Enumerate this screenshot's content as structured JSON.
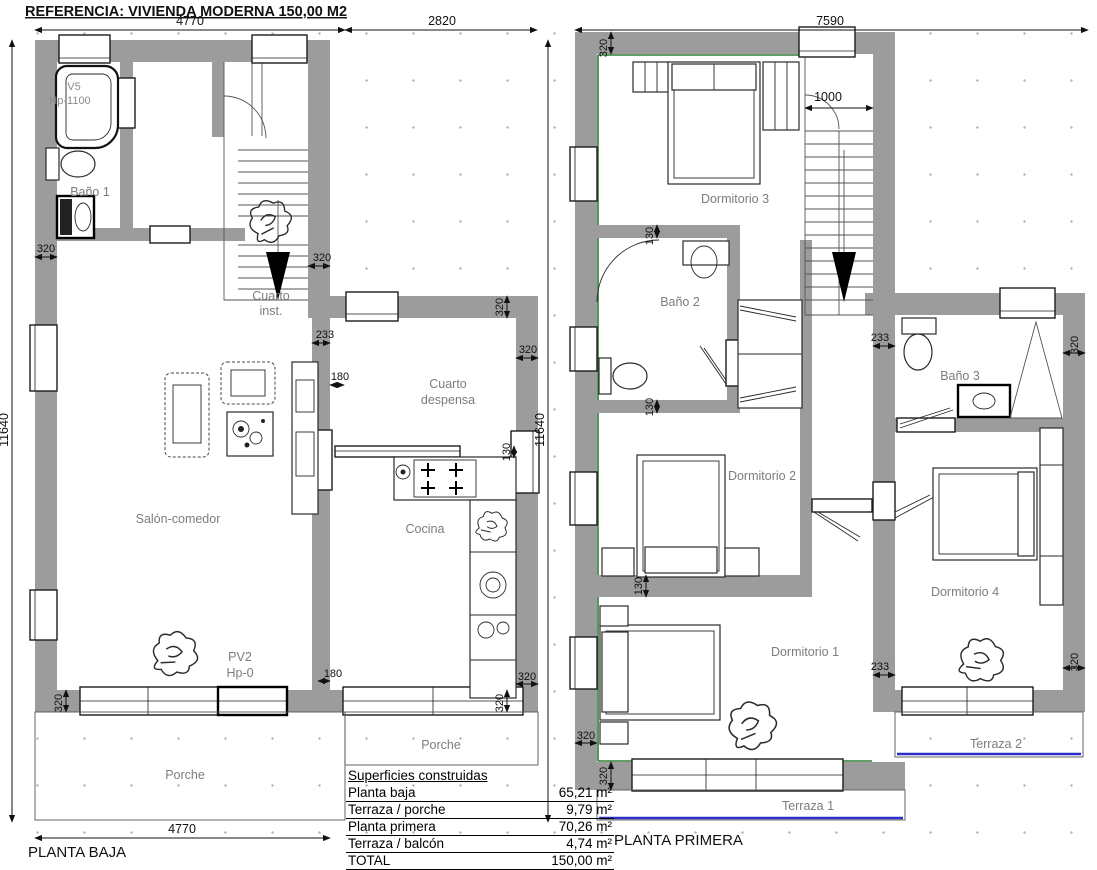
{
  "title": "REFERENCIA: VIVIENDA MODERNA 150,00 M2",
  "ground_floor": {
    "label": "PLANTA BAJA",
    "rooms": {
      "bano1": "Baño 1",
      "cuarto_inst_line1": "Cuarto",
      "cuarto_inst_line2": "inst.",
      "salon": "Salón-comedor",
      "despensa_line1": "Cuarto",
      "despensa_line2": "despensa",
      "cocina": "Cocina",
      "porche_main": "Porche",
      "porche_side": "Porche"
    },
    "fixtures": {
      "bath_window_code": "V5",
      "bath_window_height": "Hp-1100",
      "patio_door_code": "PV2",
      "patio_door_height": "Hp-0"
    }
  },
  "first_floor": {
    "label": "PLANTA PRIMERA",
    "rooms": {
      "dormitorio1": "Dormitorio 1",
      "dormitorio2": "Dormitorio 2",
      "dormitorio3": "Dormitorio 3",
      "dormitorio4": "Dormitorio 4",
      "bano2": "Baño 2",
      "bano3": "Baño 3",
      "terraza1": "Terraza 1",
      "terraza2": "Terraza 2"
    }
  },
  "dimensions": {
    "top_width_main": "4770",
    "top_width_ext": "2820",
    "bottom_width": "4770",
    "height_left": "11640",
    "top_width_first": "7590",
    "height_right": "11640",
    "stair_width": "1000",
    "wall_320": "320",
    "wall_233": "233",
    "wall_180": "180",
    "wall_130": "130"
  },
  "areas_table": {
    "header": "Superficies construidas",
    "rows": [
      {
        "label": "Planta baja",
        "value": "65,21 m²"
      },
      {
        "label": "Terraza / porche",
        "value": "9,79 m²"
      },
      {
        "label": "Planta primera",
        "value": "70,26 m²"
      },
      {
        "label": "Terraza / balcón",
        "value": "4,74 m²"
      },
      {
        "label": "TOTAL",
        "value": "150,00 m²"
      }
    ]
  },
  "colors": {
    "wall": "#9c9c9c",
    "green_line": "#2e7d32",
    "blue_line": "#2e2ec8"
  }
}
